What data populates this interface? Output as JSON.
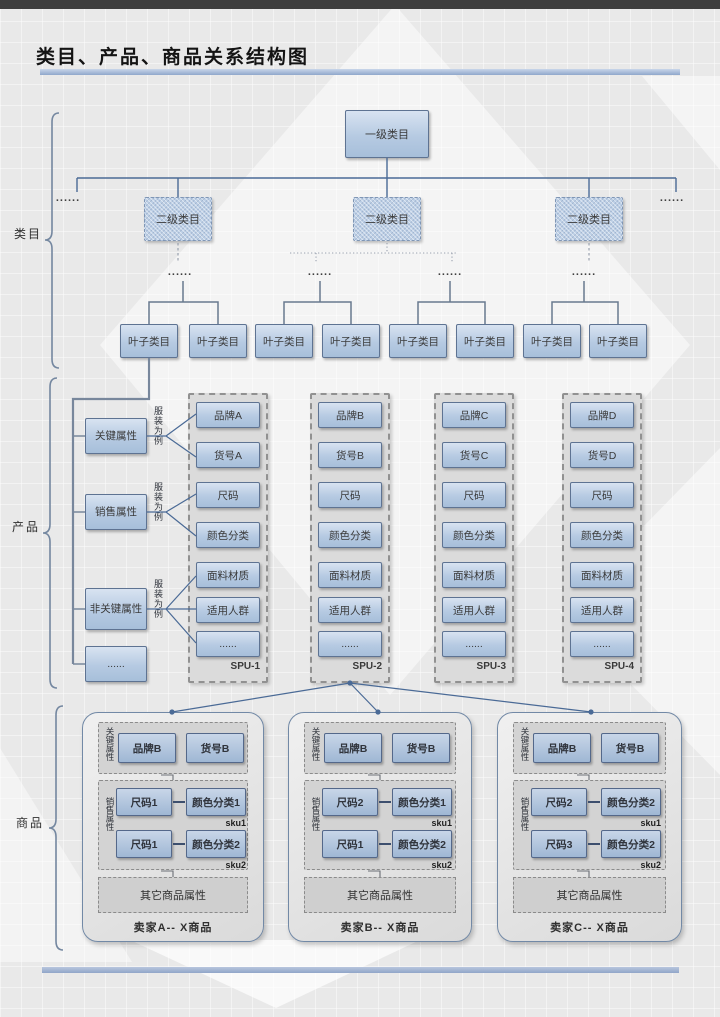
{
  "title": "类目、产品、商品关系结构图",
  "sections": {
    "catalog": "类目",
    "product": "产品",
    "commodity": "商品"
  },
  "catalog": {
    "root": "一级类目",
    "level2": [
      "二级类目",
      "二级类目",
      "二级类目"
    ],
    "leaf_label": "叶子类目",
    "ellipsis": "......"
  },
  "product": {
    "attr_groups": [
      {
        "label": "关键属性",
        "note": "服装为例"
      },
      {
        "label": "销售属性",
        "note": "服装为例"
      },
      {
        "label": "非关键属性",
        "note": "服装为例"
      },
      {
        "label": "......"
      }
    ],
    "spus": [
      {
        "name": "SPU-1",
        "items": [
          "品牌A",
          "货号A",
          "尺码",
          "颜色分类",
          "面料材质",
          "适用人群",
          "......"
        ]
      },
      {
        "name": "SPU-2",
        "items": [
          "品牌B",
          "货号B",
          "尺码",
          "颜色分类",
          "面料材质",
          "适用人群",
          "......"
        ]
      },
      {
        "name": "SPU-3",
        "items": [
          "品牌C",
          "货号C",
          "尺码",
          "颜色分类",
          "面料材质",
          "适用人群",
          "......"
        ]
      },
      {
        "name": "SPU-4",
        "items": [
          "品牌D",
          "货号D",
          "尺码",
          "颜色分类",
          "面料材质",
          "适用人群",
          "......"
        ]
      }
    ]
  },
  "commodity": {
    "sellers": [
      {
        "name": "卖家A-- X商品",
        "key_label": "关键属性",
        "key_items": [
          "品牌B",
          "货号B"
        ],
        "sales_label": "销售属性",
        "skus": [
          {
            "tag": "sku1",
            "size": "尺码1",
            "color": "颜色分类1"
          },
          {
            "tag": "sku2",
            "size": "尺码1",
            "color": "颜色分类2"
          }
        ],
        "other": "其它商品属性"
      },
      {
        "name": "卖家B-- X商品",
        "key_label": "关键属性",
        "key_items": [
          "品牌B",
          "货号B"
        ],
        "sales_label": "销售属性",
        "skus": [
          {
            "tag": "sku1",
            "size": "尺码2",
            "color": "颜色分类1"
          },
          {
            "tag": "sku2",
            "size": "尺码1",
            "color": "颜色分类2"
          }
        ],
        "other": "其它商品属性"
      },
      {
        "name": "卖家C-- X商品",
        "key_label": "关键属性",
        "key_items": [
          "品牌B",
          "货号B"
        ],
        "sales_label": "销售属性",
        "skus": [
          {
            "tag": "sku1",
            "size": "尺码2",
            "color": "颜色分类2"
          },
          {
            "tag": "sku2",
            "size": "尺码3",
            "color": "颜色分类2"
          }
        ],
        "other": "其它商品属性"
      }
    ]
  },
  "colors": {
    "box_border": "#5e7392",
    "box_fill": "#b6cae2",
    "connector": "#4a6a96",
    "underline_bar": "#9db1d3",
    "background": "#e9e9e9"
  }
}
